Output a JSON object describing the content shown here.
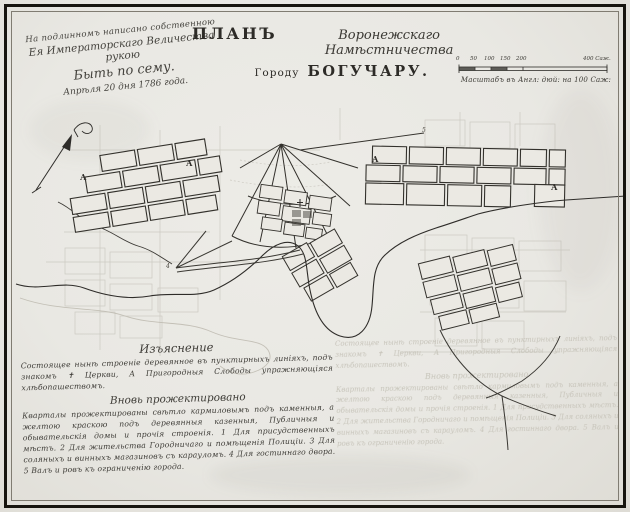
{
  "approval": {
    "line1": "На подлинномъ написано собственною",
    "line2": "Ея Императорскаго Величества рукою",
    "line3": "Быть по сему.",
    "line4": "Апрѣля 20 дня 1786 года."
  },
  "title": {
    "plan": "ПЛАНЪ",
    "province_script": "Воронежскаго Намѣстничества",
    "gorodu": "Городу",
    "city": "БОГУЧАРУ."
  },
  "scale": {
    "tick_labels": [
      "0",
      "50",
      "100",
      "150",
      "200"
    ],
    "end_label": "400 Саж.",
    "caption": "Масштабъ въ Англ: дюй: на 100 Саж:"
  },
  "legend": {
    "header_explanation": "Изъяснение",
    "explanation_text": "Состоящее нынѣ строенiе деревянное въ пунктирныхъ линiяхъ, подъ знакомъ ✝ Церкви, А Пригородныя Слободы упражняющiяся хлѣбопашествомъ.",
    "header_projected": "Вновь прожектировано",
    "projected_text": "Кварталы прожектированы свѣтло кармиловымъ подъ каменныя, а желтою краскою подъ деревянныя казенныя, Публичныя и обывательскiя домы и прочiя строенiя. 1 Для присудственныхъ мѣстъ. 2 Для жительства Городничаго и помѣщенiя Полицiи. 3 Для соляныхъ и винныхъ магазиновъ съ карауломъ. 4 Для гостиннаго двора. 5 Валъ и ровъ къ ограниченiю города."
  },
  "map": {
    "block_letters": [
      {
        "text": "А"
      },
      {
        "text": "А"
      },
      {
        "text": "А"
      },
      {
        "text": "А"
      }
    ],
    "ref_marks": [
      {
        "text": "5"
      },
      {
        "text": "4"
      }
    ]
  },
  "colors": {
    "ink": "#2e2c29",
    "pencil": "#b8b5ab",
    "paper": "#eae8e2",
    "frame": "#17150f"
  }
}
